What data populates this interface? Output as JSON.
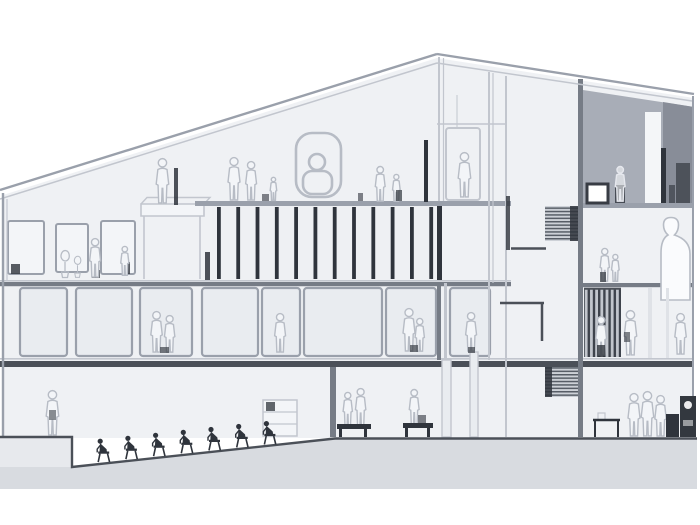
{
  "drawing": {
    "kind": "architectural-section",
    "logo_glyph": "8",
    "storeys_visible": 4
  },
  "colors": {
    "bg": "#ffffff",
    "interior": "#eff1f4",
    "panel": "#e9ecf0",
    "panel-light": "#f3f5f8",
    "line-light": "#c2c6ce",
    "line-mid": "#9aa0ab",
    "line-mdark": "#767c86",
    "line-dark": "#4b5058",
    "ink": "#2f343c",
    "sketch": "#b7bcc5",
    "ground": "#d8dbe0",
    "pit": "#e7e9ed",
    "shade-mid": "#a8adb7",
    "shade-dark": "#888d98",
    "white-obj": "#fafbfd"
  },
  "scene": {
    "roof_slats_count": 12,
    "window_panels_count": 8,
    "easel_panels_count": 3,
    "ramp_figures_count": 7,
    "stair_flights_count": 2,
    "sketched_figures_count": 28
  }
}
